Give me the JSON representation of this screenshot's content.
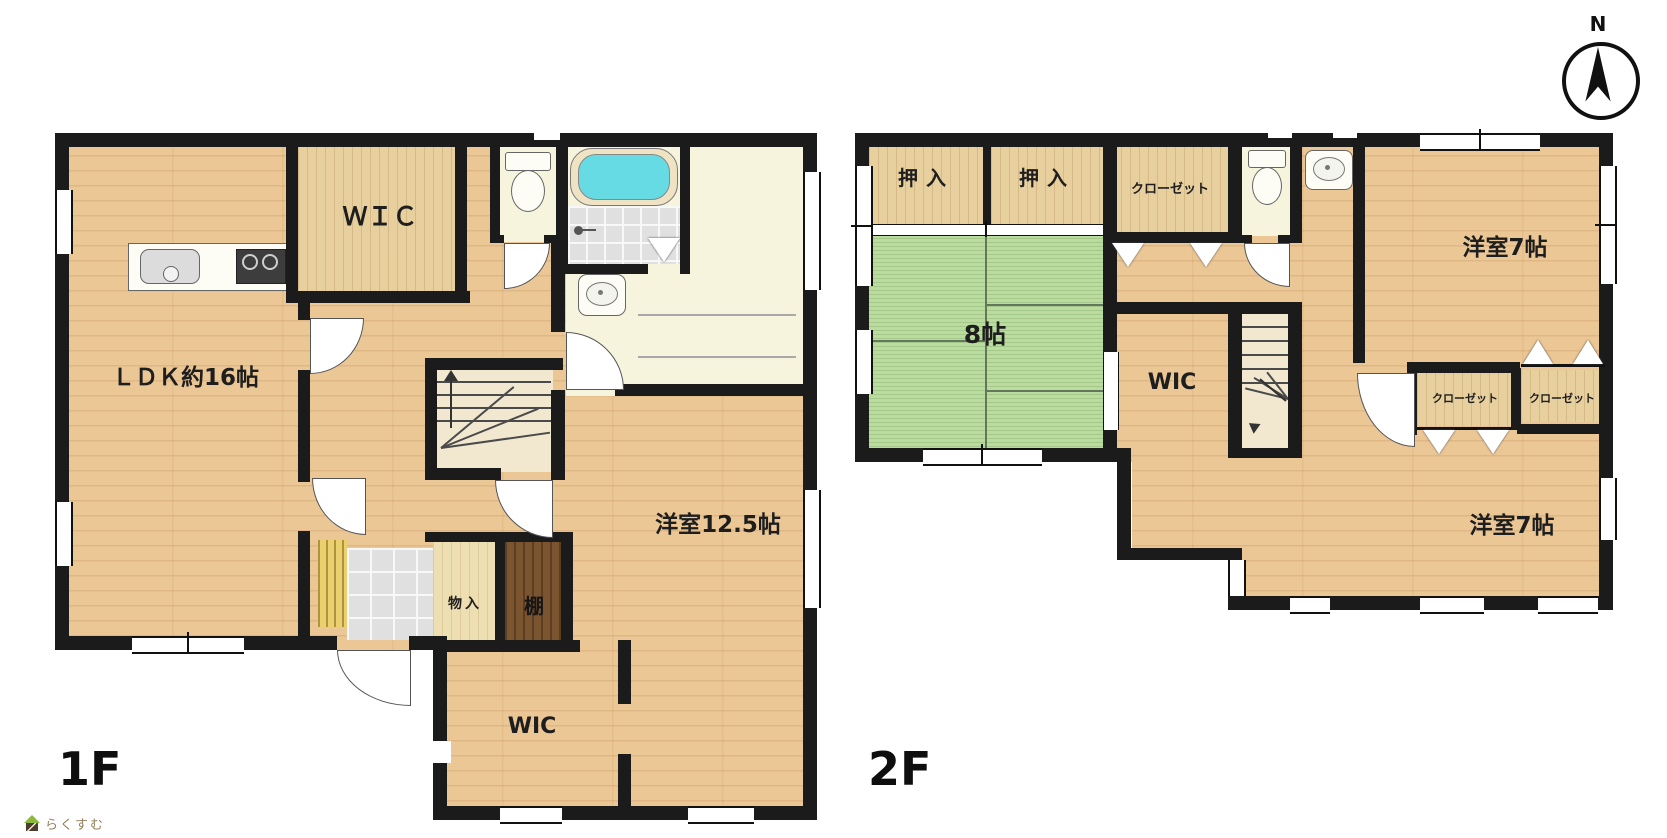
{
  "compass": {
    "north_label": "N"
  },
  "logo": {
    "text": "らくすむ"
  },
  "floor1": {
    "label": "1F",
    "rooms": {
      "ldk": {
        "label": "ＬＤＫ約16帖"
      },
      "wic_top": {
        "label": "ＷＩＣ"
      },
      "yoshitsu": {
        "label": "洋室12.5帖"
      },
      "monoire": {
        "label": "物入"
      },
      "tana": {
        "label": "棚"
      },
      "wic_bottom": {
        "label": "WIC"
      }
    }
  },
  "floor2": {
    "label": "2F",
    "rooms": {
      "oshiire_left": {
        "label": "押入"
      },
      "oshiire_right": {
        "label": "押入"
      },
      "closet_top": {
        "label": "クローゼット"
      },
      "tatami": {
        "label": "8帖"
      },
      "wic": {
        "label": "WIC"
      },
      "yoshitsu_top": {
        "label": "洋室7帖"
      },
      "closet_left": {
        "label": "クローゼット"
      },
      "closet_right": {
        "label": "クローゼット"
      },
      "yoshitsu_bottom": {
        "label": "洋室7帖"
      }
    }
  },
  "colors": {
    "wall": "#1b1b1b",
    "wood_floor": "#ecc796",
    "closet_wood": "#e7cf9e",
    "tatami_green": "#badc9f",
    "wet_area_cream": "#f7f4de",
    "entrance_tile": "#e0e0e0",
    "shelf_brown": "#7b5530",
    "bathtub_cyan": "#66dbe4",
    "step_board_yellow": "#ead06e"
  }
}
